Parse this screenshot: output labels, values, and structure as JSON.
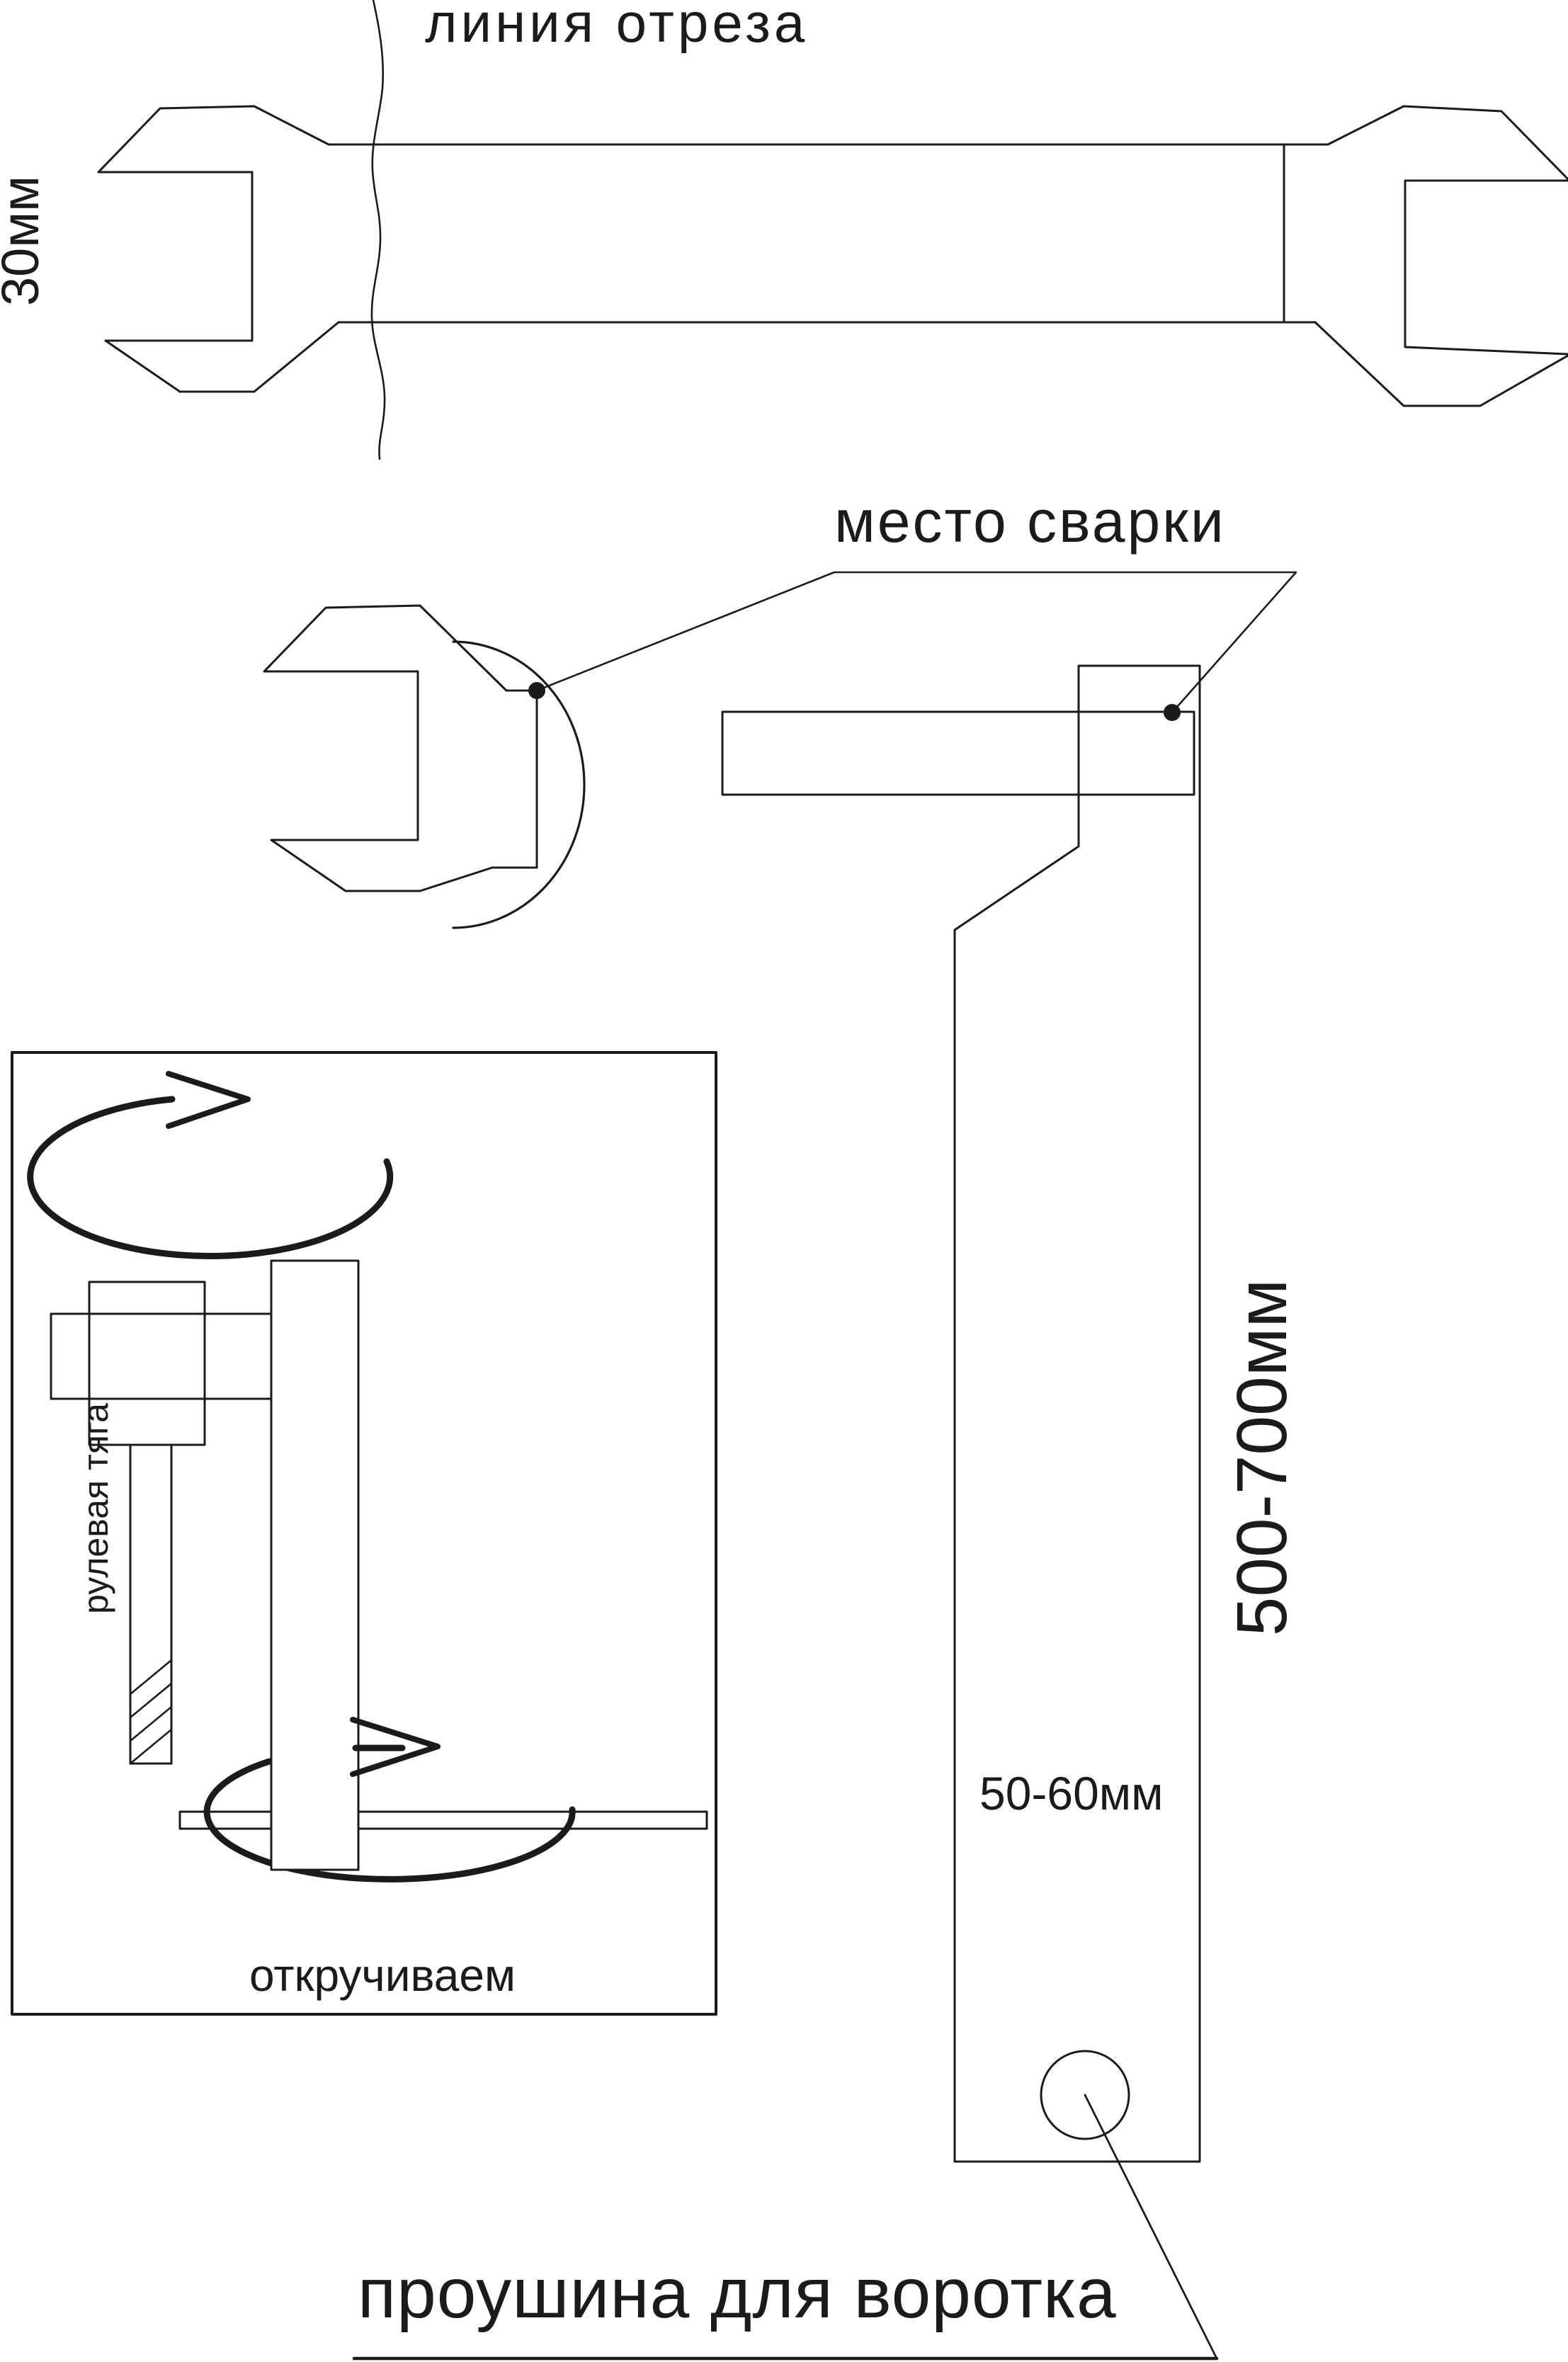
{
  "labels": {
    "cut_line_title": "линия отреза",
    "wrench_size": "30мм",
    "weld_spot": "место сварки",
    "rod_length": "500-700мм",
    "hole_offset": "50-60мм",
    "steering_rod": "рулевая тяга",
    "unscrew": "откручиваем",
    "eye_for_lever": "проушина для воротка"
  },
  "colors": {
    "ink": "#1b1b1b",
    "background": "#ffffff"
  }
}
